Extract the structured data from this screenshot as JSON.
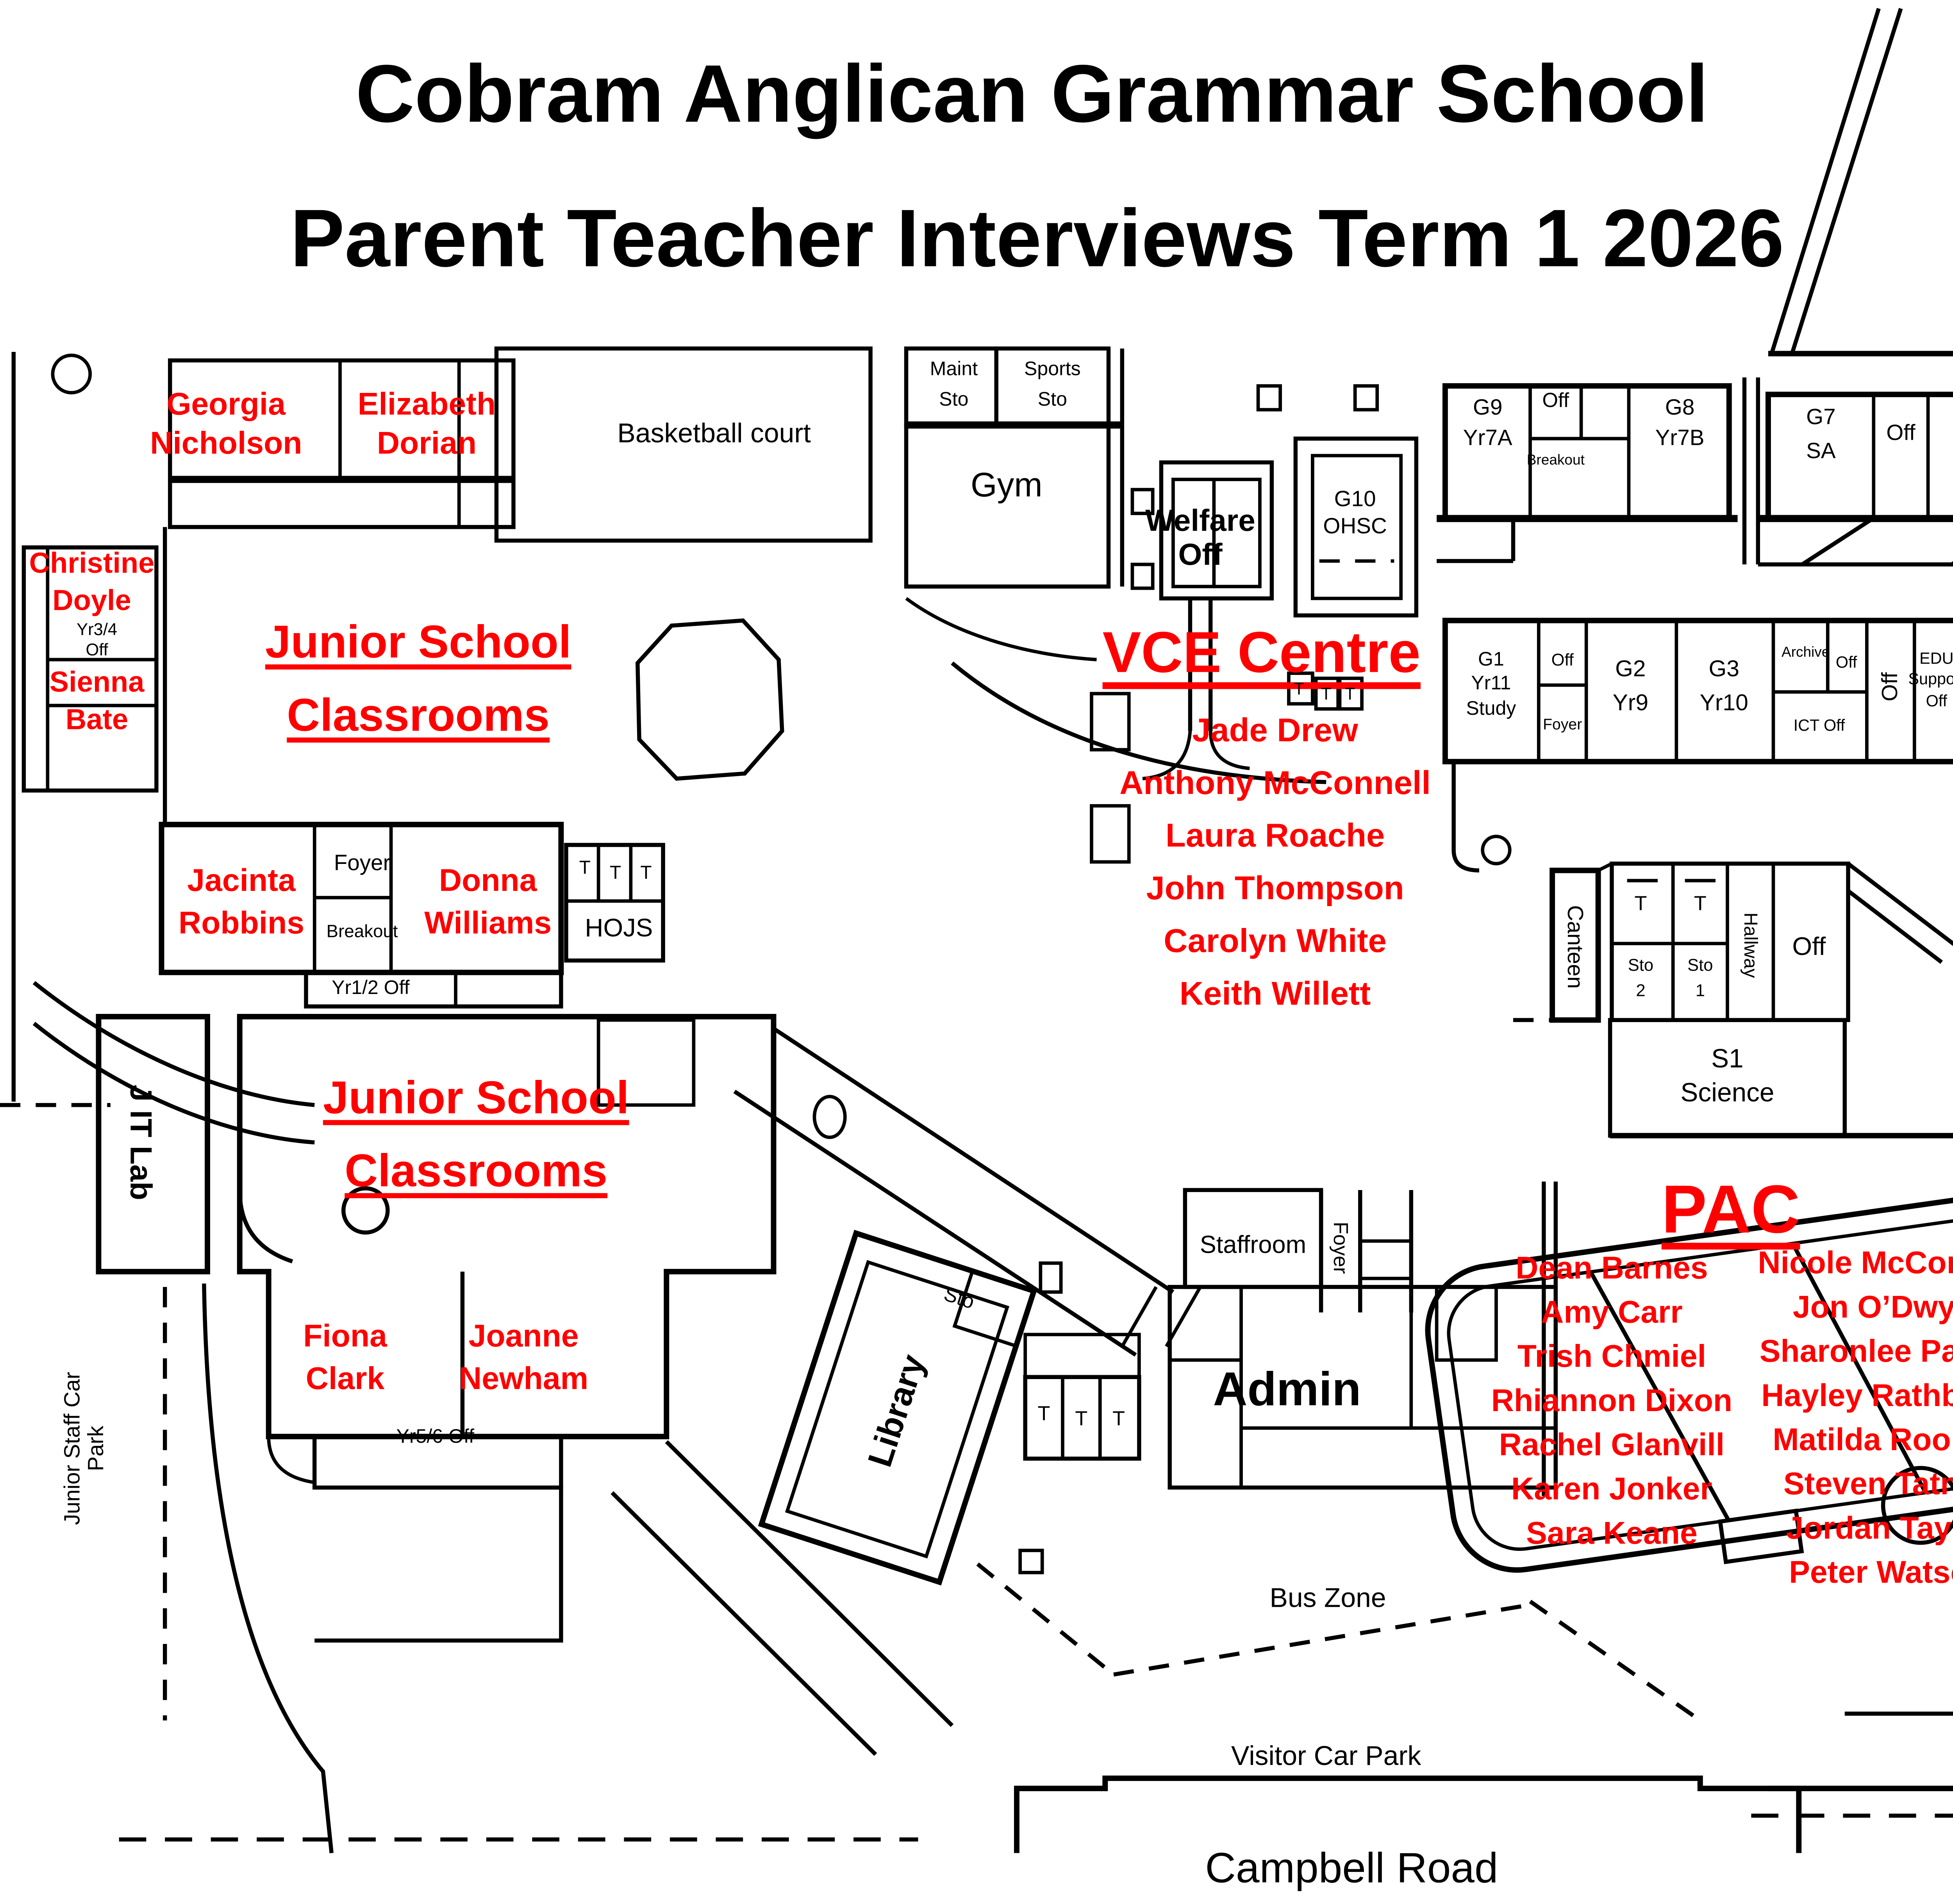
{
  "title": {
    "line1": "Cobram Anglican Grammar School",
    "line2": "Parent Teacher Interviews Term 1 2026"
  },
  "colors": {
    "accent_red": "#FF0000",
    "ink": "#000000",
    "background": "#FFFFFF"
  },
  "headings": {
    "junior_school_upper": {
      "line1": "Junior School",
      "line2": "Classrooms"
    },
    "junior_school_lower": {
      "line1": "Junior School",
      "line2": "Classrooms"
    },
    "vce_centre": "VCE Centre",
    "pac": "PAC"
  },
  "teachers": {
    "georgia_nicholson": "Georgia Nicholson",
    "elizabeth_dorian": "Elizabeth Dorian",
    "christine_doyle": "Christine Doyle",
    "sienna_bate": "Sienna Bate",
    "jacinta_robbins": "Jacinta Robbins",
    "donna_williams": "Donna Williams",
    "fiona_clark": "Fiona Clark",
    "joanne_newham": "Joanne Newham",
    "vce_list": [
      "Jade Drew",
      "Anthony McConnell",
      "Laura Roache",
      "John Thompson",
      "Carolyn White",
      "Keith Willett"
    ],
    "pac_left": [
      "Dean Barnes",
      "Amy Carr",
      "Trish Chmiel",
      "Rhiannon Dixon",
      "Rachel Glanvill",
      "Karen Jonker",
      "Sara Keane"
    ],
    "pac_right": [
      "Nicole McConnell",
      "Jon O’Dwyer",
      "Sharonlee Parker",
      "Hayley Rathbone",
      "Matilda Rooney",
      "Steven Tatnall",
      "Jordan Taylor",
      "Peter Watson"
    ]
  },
  "rooms": {
    "basketball_court": "Basketball court",
    "maint_sto": "Maint Sto",
    "sports_sto": "Sports Sto",
    "gym": "Gym",
    "welfare_off": "Welfare Off",
    "g10_ohsc": "G10 OHSC",
    "g9": "G9 Yr7A",
    "off": "Off",
    "breakout": "Breakout",
    "g8": "G8 Yr7B",
    "g7": "G7 SA",
    "g6": "G6 VM",
    "g1": "G1 Yr11 Study",
    "foyer": "Foyer",
    "g2": "G2 Yr9",
    "g3": "G3 Yr10",
    "archive": "Archive",
    "ict_off": "ICT Off",
    "edu_support_off": "EDU Support Off",
    "g4": "G4 Yr8A",
    "g5": "G5 Yr8B",
    "t": "T",
    "hojs": "HOJS",
    "yr12_off": "Yr1/2 Off",
    "yr34_off": "Yr3/4 Off",
    "yr56_off": "Yr5/6 Off",
    "j_it_lab": "J IT Lab",
    "canteen": "Canteen",
    "sto_2": "Sto 2",
    "sto_1": "Sto 1",
    "hallway": "Hallway",
    "s1_science": "S1 Science",
    "a7_foods": "A7 Foods",
    "art_sto": "Art Sto",
    "kiln": "Kiln",
    "a2": "A2",
    "a1_art": "A1 Art",
    "chair_sto": "Chair Sto",
    "s2_science": "S2 Science",
    "music_off": "Music Off",
    "music_pod": "Music Pod",
    "a4": "A4",
    "a4_music": "Music",
    "staffroom": "Staffroom",
    "admin": "Admin",
    "library": "Library",
    "sto": "Sto"
  },
  "areas": {
    "bus_zone": "Bus Zone",
    "visitor_car_park": "Visitor Car Park",
    "admin_car_park": "Admin Car Park",
    "campbell_road": "Campbell Road",
    "parent_car_park": "Parent Car Park",
    "junior_staff_car_park": "Junior Staff Car Park"
  }
}
